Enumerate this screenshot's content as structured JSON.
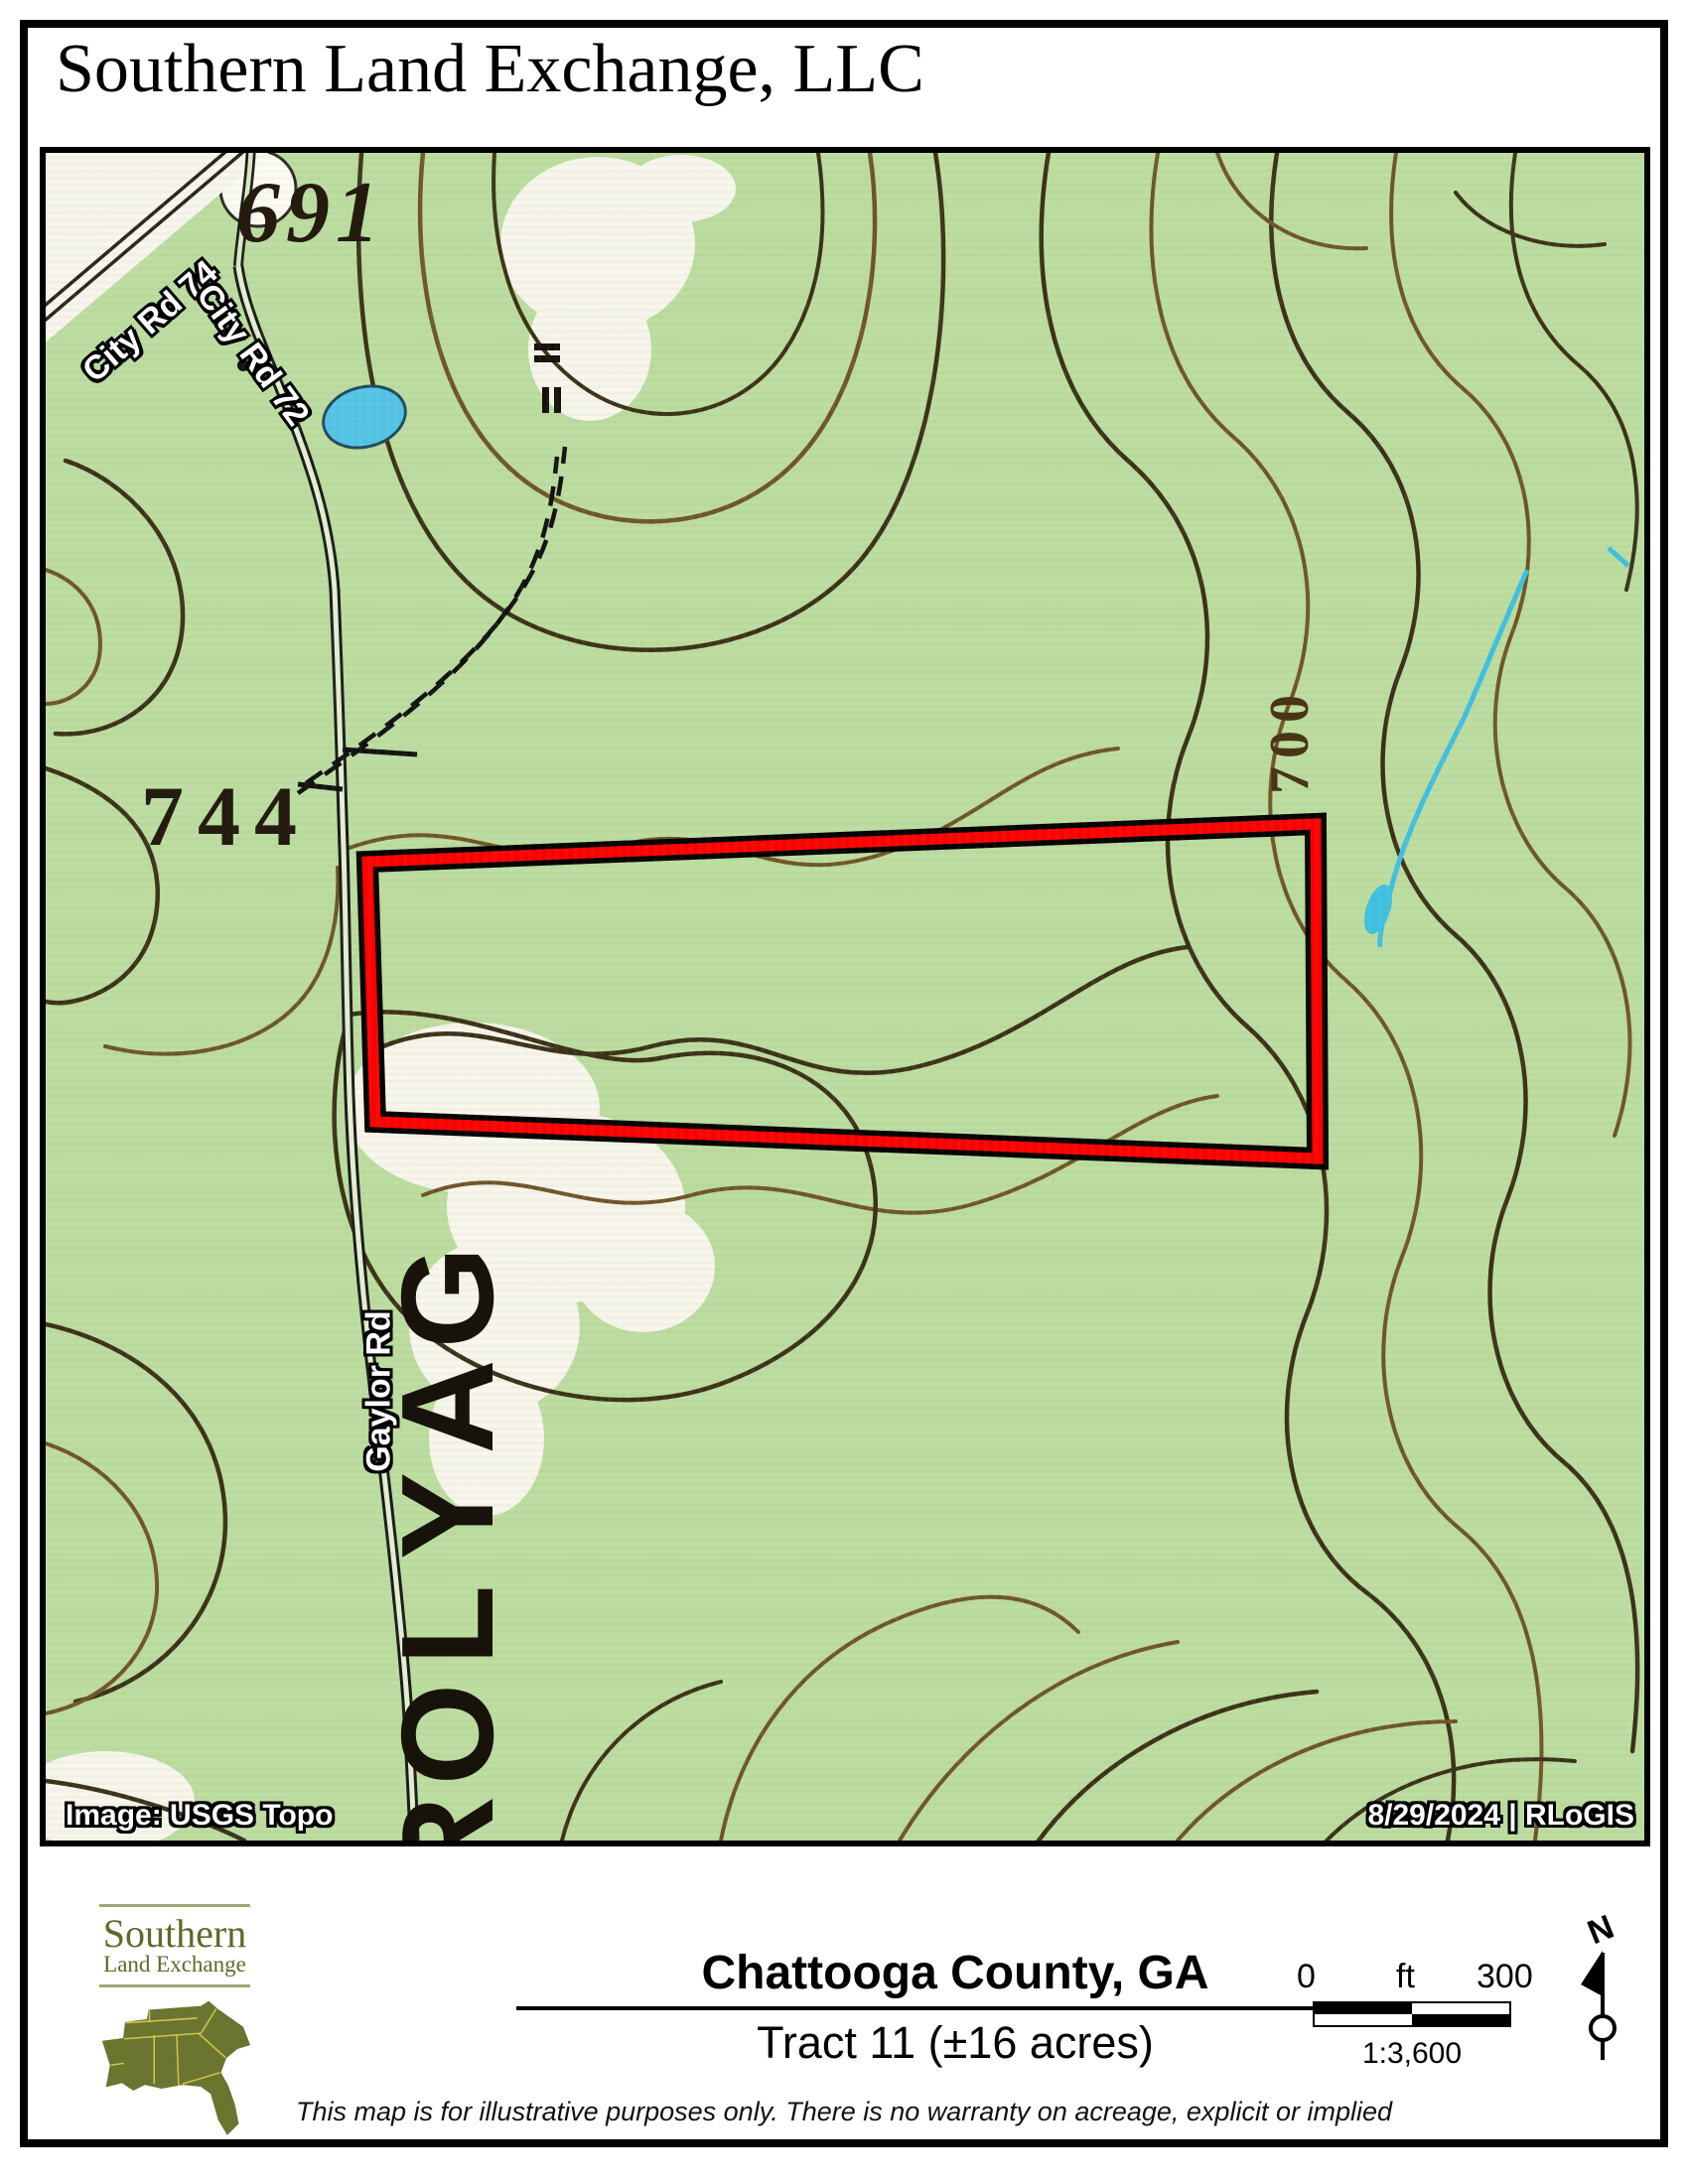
{
  "page": {
    "title": "Southern Land Exchange, LLC"
  },
  "map": {
    "labels": {
      "city_rd_74": "City Rd 74",
      "city_rd_72": "City Rd 72",
      "gaylor_rd": "Gaylor Rd",
      "gaylor_large": "GAYLOR",
      "elev_691": "691",
      "elev_744": "744",
      "elev_700": "700"
    },
    "credits": {
      "source": "Image: USGS Topo",
      "date": "8/29/2024  |  RLoGIS"
    },
    "colors": {
      "parcel_outline": "#ff0000",
      "basemap_green": "#bcdca0",
      "contour_brown": "#6f5526",
      "water_blue": "#45c2e4"
    }
  },
  "footer": {
    "logo": {
      "name_top": "Southern",
      "name_bottom": "Land Exchange",
      "color": "#5c6b28"
    },
    "title": "Chattooga County, GA",
    "subtitle": "Tract 11 (±16 acres)",
    "scalebar": {
      "start": "0",
      "unit": "ft",
      "end": "300",
      "ratio": "1:3,600"
    },
    "north_label": "N",
    "disclaimer": "This map is for illustrative purposes only.  There is no warranty on acreage, explicit or implied"
  }
}
